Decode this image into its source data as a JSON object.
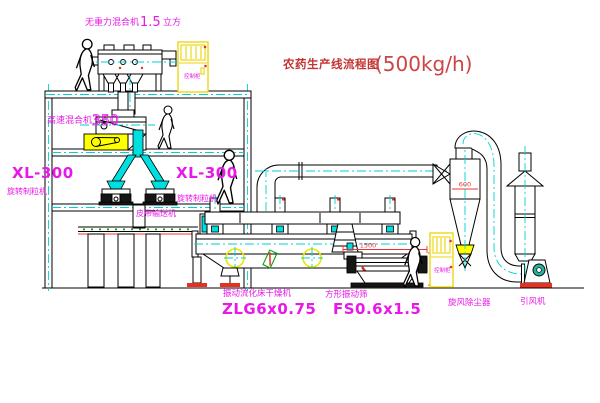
{
  "title": {
    "name": "农药生产线流程图",
    "capacity": "(500kg/h)"
  },
  "labels": {
    "gravity_mixer_name": "无重力混合机",
    "gravity_mixer_size": "1.5",
    "gravity_mixer_unit": "立方",
    "high_speed_mixer_name": "高速混合机",
    "high_speed_mixer_size": "350",
    "granulator_model": "XL-300",
    "granulator_name": "旋转制粒机",
    "belt_conveyor": "皮带输送机",
    "dryer_name": "振动流化床干燥机",
    "dryer_model": "ZLG6x0.75",
    "sieve_name": "方形振动筛",
    "sieve_model": "FS0.6x1.5",
    "cyclone_name": "旋风除尘器",
    "fan_name": "引风机",
    "control_cabinet": "控制柜"
  },
  "dimensions": {
    "cyclone_width": "600",
    "sieve_length": "1500",
    "sieve_height": "540"
  },
  "colors": {
    "background": "#ffffff",
    "line": "#000000",
    "centerline_cyan": "#00d2d2",
    "label_magenta": "#e818e8",
    "title_red": "#c23333",
    "dimension_red": "#f03030",
    "highlight_yellow": "#ffff00",
    "belt_green": "#00a800",
    "motor_teal": "#28b0a0"
  }
}
